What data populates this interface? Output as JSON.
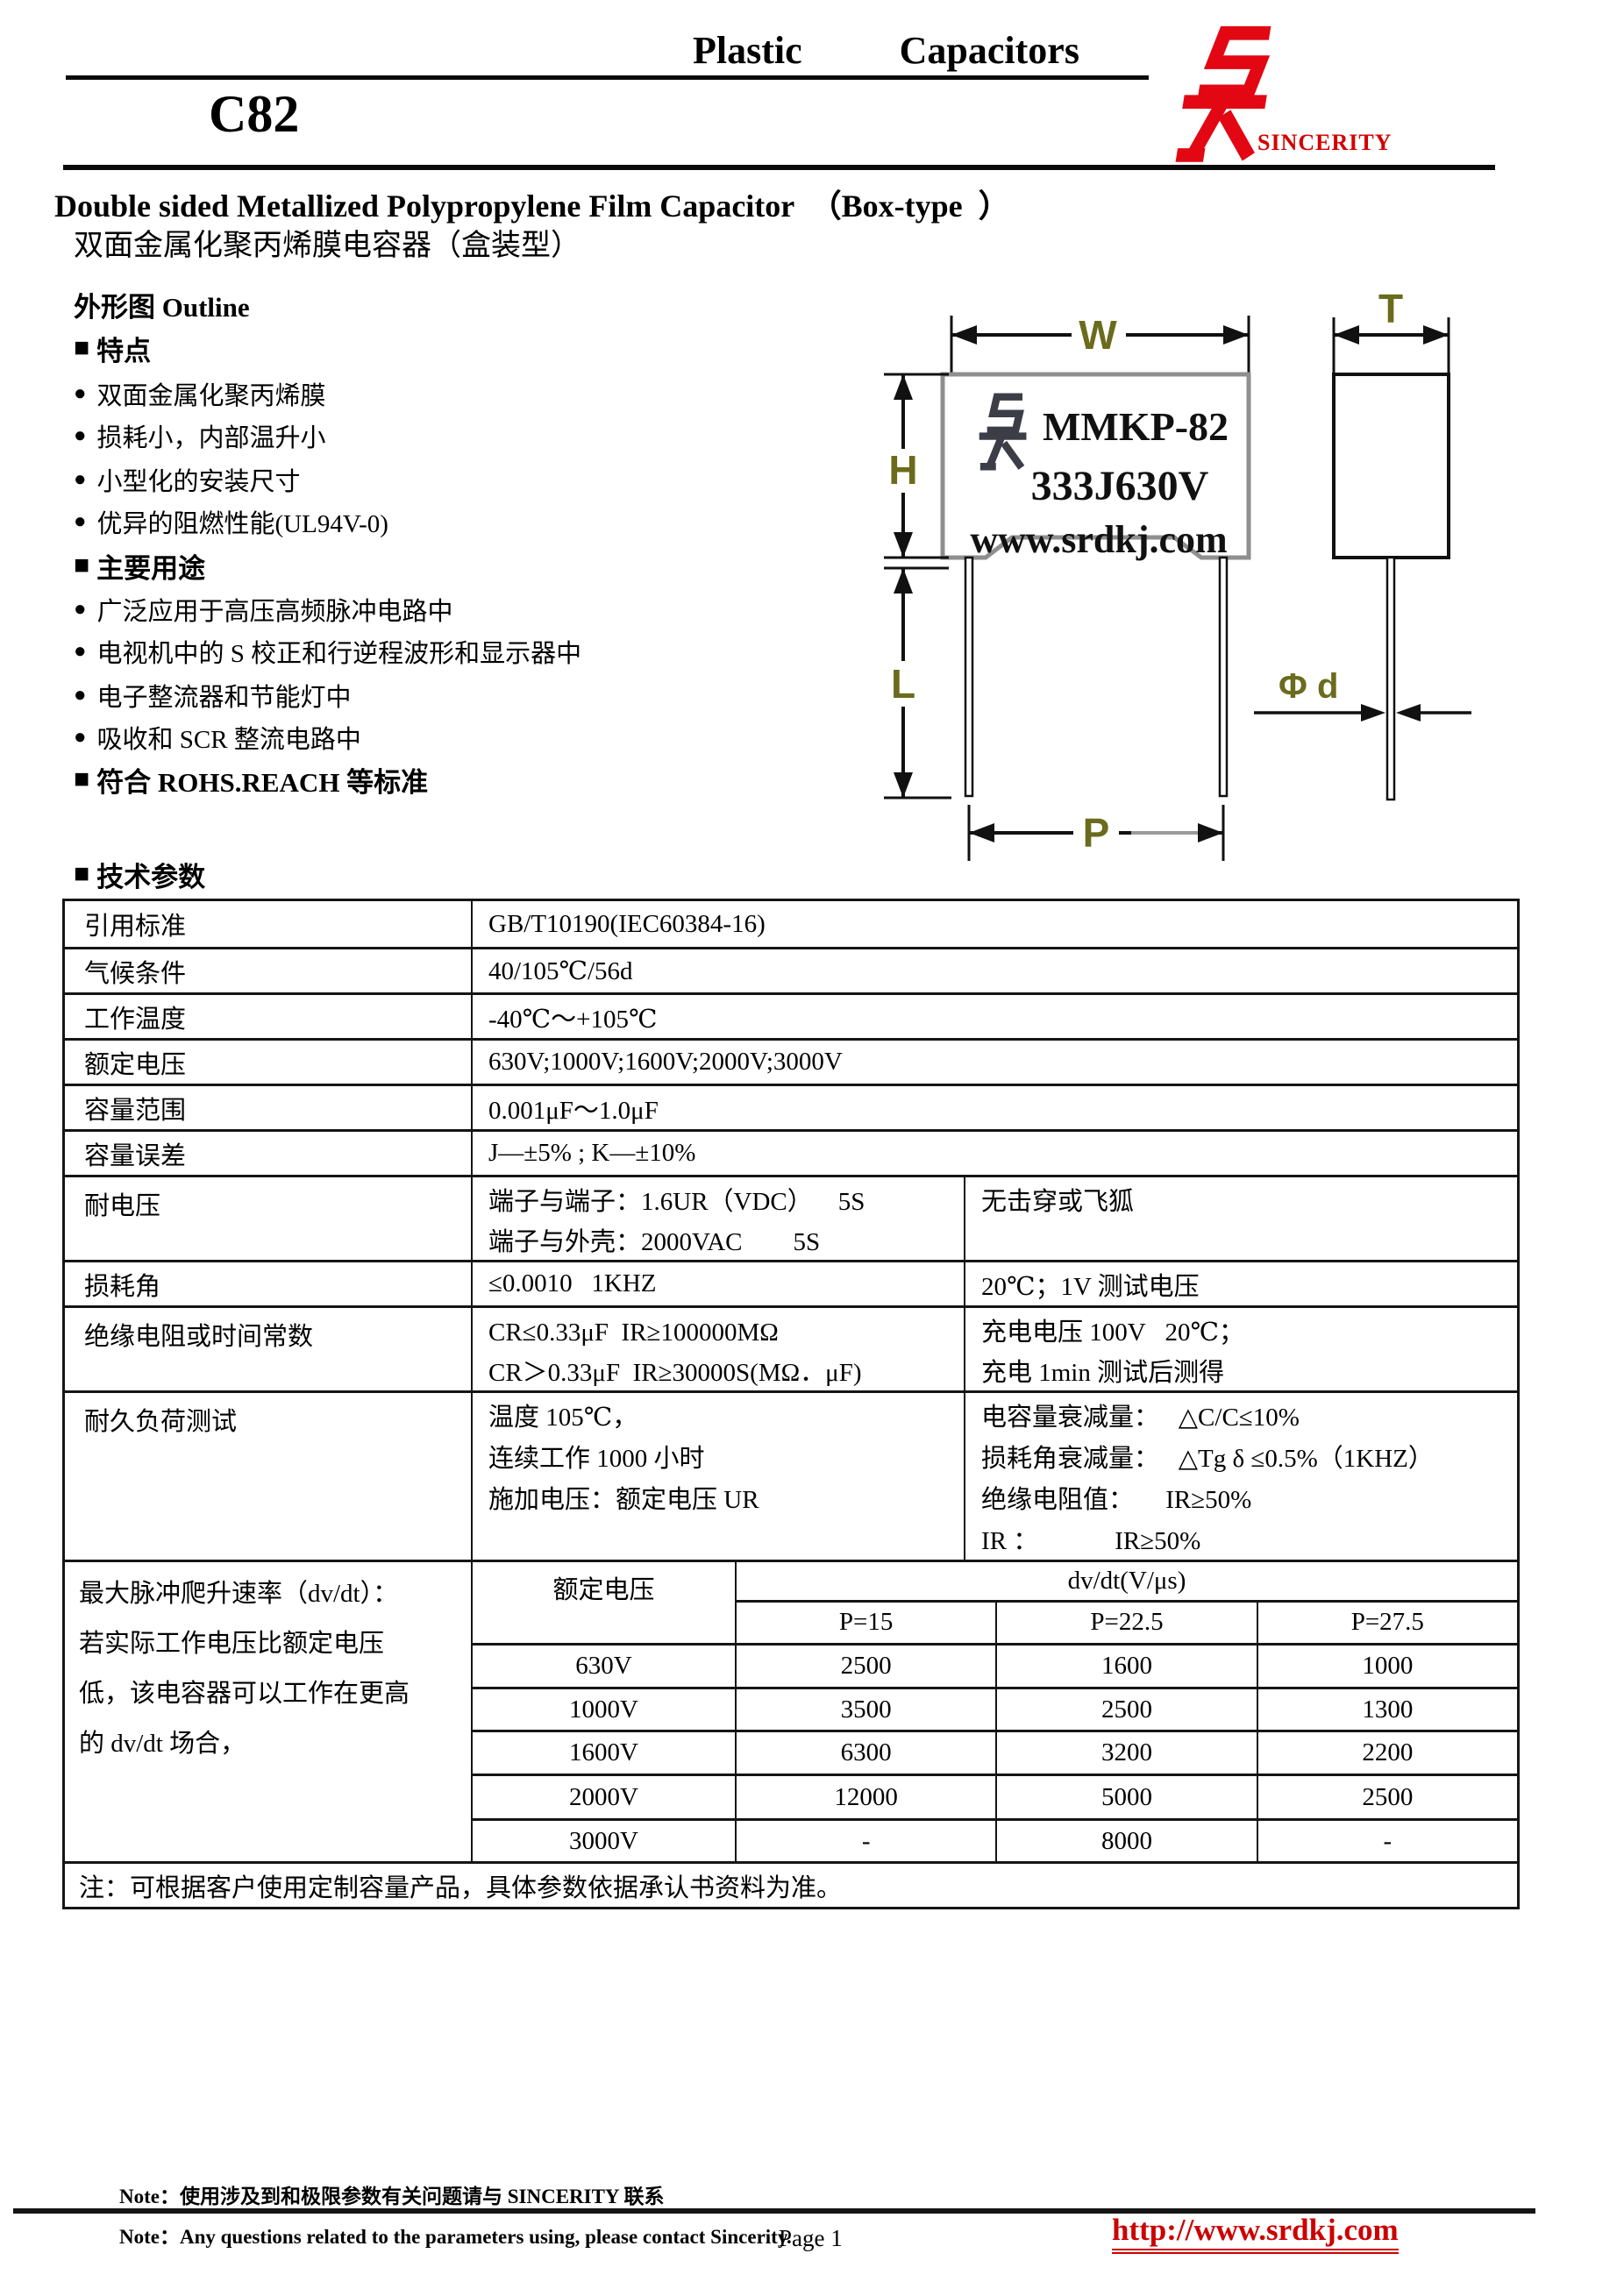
{
  "icons": {
    "square": "■",
    "bullet": "●"
  },
  "header": {
    "doc_title": "Plastic   Capacitors",
    "model": "C82",
    "brand": "SINCERITY",
    "title_en": "Double sided Metallized Polypropylene Film Capacitor  （Box-type  ）",
    "title_cn": "双面金属化聚丙烯膜电容器（盒装型）"
  },
  "outline": {
    "heading": "外形图  Outline",
    "features_title": "特点",
    "features": [
      "双面金属化聚丙烯膜",
      "损耗小，内部温升小",
      "小型化的安装尺寸",
      "优异的阻燃性能(UL94V-0)"
    ],
    "uses_title": "主要用途",
    "uses": [
      "广泛应用于高压高频脉冲电路中",
      "电视机中的 S 校正和行逆程波形和显示器中",
      "电子整流器和节能灯中",
      "吸收和 SCR 整流电路中"
    ],
    "rohs": "符合 ROHS.REACH 等标准"
  },
  "diagram": {
    "dims": {
      "w": "W",
      "t": "T",
      "h": "H",
      "l": "L",
      "p": "P",
      "d": "Φ d"
    },
    "marking": [
      "MMKP-82",
      "333J630V",
      "www.srdkj.com"
    ],
    "label_color": "#6b6b1d"
  },
  "specs": {
    "heading": "技术参数",
    "rows": [
      {
        "label": "引用标准",
        "value": "GB/T10190(IEC60384-16)"
      },
      {
        "label": "气候条件",
        "value": "40/105℃/56d"
      },
      {
        "label": "工作温度",
        "value": "-40℃～+105℃"
      },
      {
        "label": "额定电压",
        "value": "630V;1000V;1600V;2000V;3000V"
      },
      {
        "label": "容量范围",
        "value": "0.001μF～1.0μF"
      },
      {
        "label": "容量误差",
        "value": "J—±5% ; K—±10%"
      },
      {
        "label": "耐电压",
        "mid": [
          "端子与端子：1.6UR（VDC）    5S",
          "端子与外壳：2000VAC        5S"
        ],
        "right": [
          "无击穿或飞狐"
        ]
      },
      {
        "label": "损耗角",
        "mid": [
          "≤0.0010   1KHZ"
        ],
        "right": [
          "20℃；1V 测试电压"
        ]
      },
      {
        "label": "绝缘电阻或时间常数",
        "mid": [
          "CR≤0.33μF  IR≥100000MΩ",
          "CR＞0.33μF  IR≥30000S(MΩ．μF)"
        ],
        "right": [
          "充电电压 100V   20℃；",
          "充电 1min 测试后测得"
        ]
      },
      {
        "label": "耐久负荷测试",
        "mid": [
          "温度 105℃，",
          "连续工作 1000 小时",
          "施加电压：额定电压 UR"
        ],
        "right": [
          "电容量衰减量：   △C/C≤10%",
          "损耗角衰减量：   △Tg δ ≤0.5%（1KHZ）",
          "绝缘电阻值：     IR≥50%",
          "IR ：            IR≥50%"
        ]
      }
    ]
  },
  "dvdt": {
    "label_lines": [
      "最大脉冲爬升速率（dv/dt）：",
      "若实际工作电压比额定电压",
      "低，该电容器可以工作在更高",
      "的 dv/dt 场合，"
    ],
    "rated_header": "额定电压",
    "unit_header": "dv/dt(V/μs)",
    "p_headers": [
      "P=15",
      "P=22.5",
      "P=27.5"
    ],
    "rows": [
      {
        "v": "630V",
        "p15": "2500",
        "p225": "1600",
        "p275": "1000"
      },
      {
        "v": "1000V",
        "p15": "3500",
        "p225": "2500",
        "p275": "1300"
      },
      {
        "v": "1600V",
        "p15": "6300",
        "p225": "3200",
        "p275": "2200"
      },
      {
        "v": "2000V",
        "p15": "12000",
        "p225": "5000",
        "p275": "2500"
      },
      {
        "v": "3000V",
        "p15": "-",
        "p225": "8000",
        "p275": "-"
      }
    ],
    "note": "注：可根据客户使用定制容量产品，具体参数依据承认书资料为准。"
  },
  "footer": {
    "note_cn": "Note：使用涉及到和极限参数有关问题请与 SINCERITY 联系",
    "note_en": "Note：Any questions related to the parameters using, please contact Sincerity.",
    "page": "Page 1",
    "url": "http://www.srdkj.com"
  }
}
